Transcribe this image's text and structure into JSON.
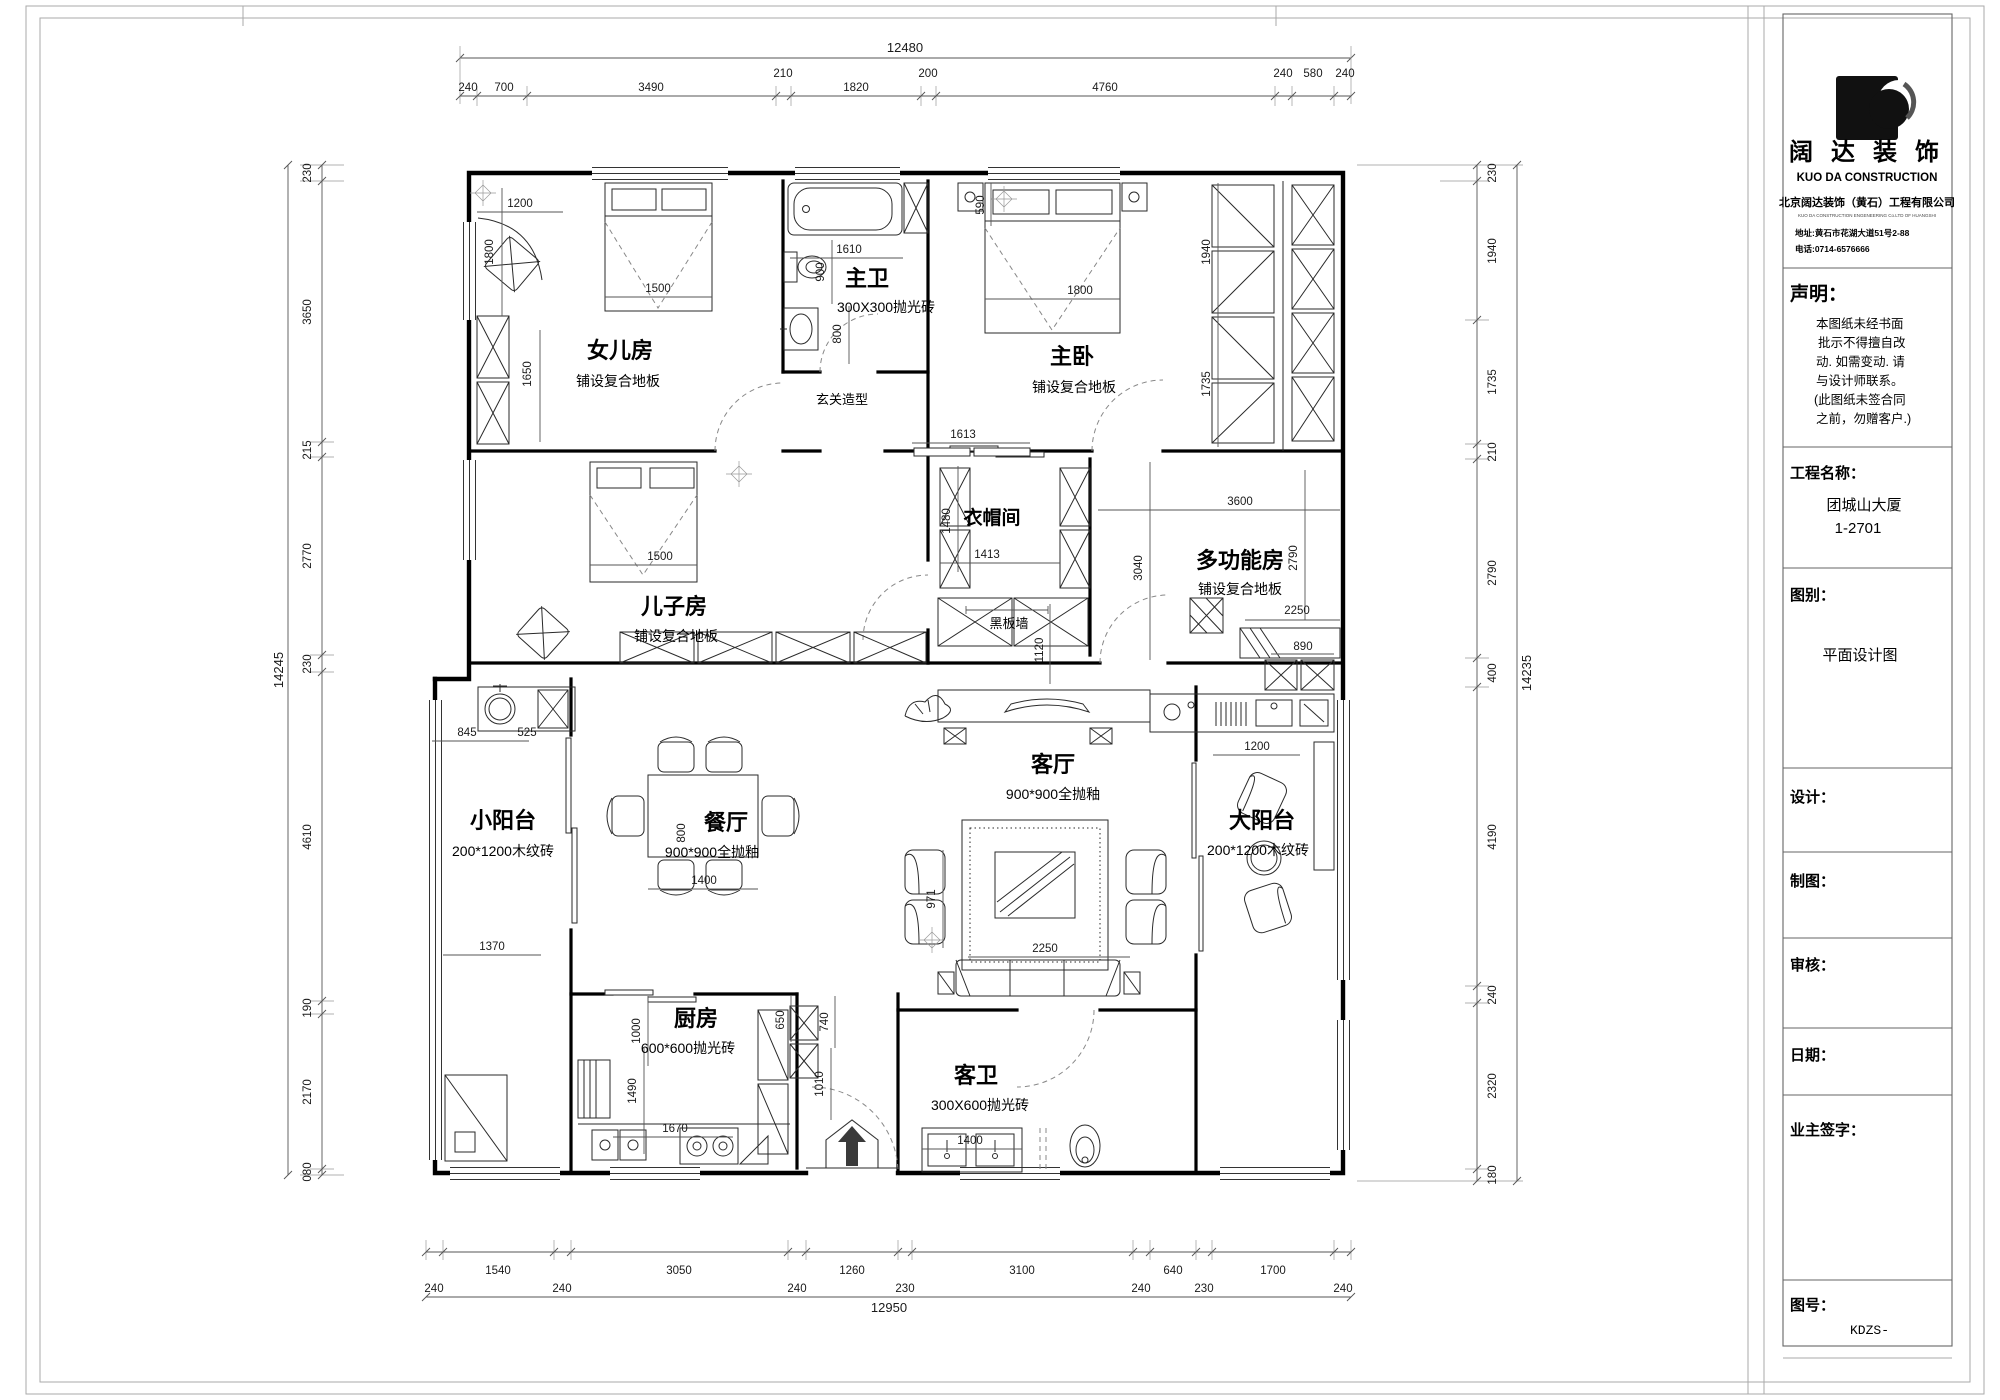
{
  "title_block": {
    "logo_title": "阔 达 装 饰",
    "logo_subtitle": "KUO DA CONSTRUCTION",
    "company_cn": "北京阔达装饰（黄石）工程有限公司",
    "company_en": "KUO DA CONSTRUCTION ENGENEERING Co.LTD OF HUANGSHI",
    "address": "地址:黄石市花湖大道51号2-88",
    "phone": "电话:0714-6576666",
    "statement_label": "声明：",
    "statement_lines": [
      "本图纸未经书面",
      "批示不得擅自改",
      "动. 如需变动. 请",
      "与设计师联系。",
      "(此图纸未签合同",
      "之前，勿赠客户.)"
    ],
    "project_label": "工程名称：",
    "project_name": "团城山大厦",
    "project_unit": "1-2701",
    "type_label": "图别：",
    "type_value": "平面设计图",
    "design_label": "设计：",
    "draft_label": "制图：",
    "check_label": "审核：",
    "date_label": "日期：",
    "owner_label": "业主签字：",
    "no_label": "图号：",
    "no_value": "KDZS-"
  },
  "plan": {
    "rooms": {
      "nver": {
        "name": "女儿房",
        "floor": "铺设复合地板"
      },
      "zhuwei": {
        "name": "主卫",
        "floor": "300X300抛光砖"
      },
      "zhuwo": {
        "name": "主卧",
        "floor": "铺设复合地板"
      },
      "erzi": {
        "name": "儿子房",
        "floor": "铺设复合地板"
      },
      "yimao": {
        "name": "衣帽间"
      },
      "duogong": {
        "name": "多功能房",
        "floor": "铺设复合地板"
      },
      "keting": {
        "name": "客厅",
        "floor": "900*900全抛釉"
      },
      "canting": {
        "name": "餐厅",
        "floor": "900*900全抛釉"
      },
      "xiaoyangtai": {
        "name": "小阳台",
        "floor": "200*1200木纹砖"
      },
      "dayangtai": {
        "name": "大阳台",
        "floor": "200*1200木纹砖"
      },
      "chufang": {
        "name": "厨房",
        "floor": "600*600抛光砖"
      },
      "kewei": {
        "name": "客卫",
        "floor": "300X600抛光砖"
      }
    },
    "annotations": {
      "xuanguan": "玄关造型",
      "heibanqiang": "黑板墙"
    },
    "dims": {
      "top": {
        "total": "12480",
        "segments": [
          "240",
          "700",
          "3490",
          "210",
          "1820",
          "200",
          "4760",
          "240",
          "580",
          "240"
        ]
      },
      "bottom": {
        "total": "12950",
        "segments": [
          "240",
          "1540",
          "240",
          "3050",
          "240",
          "1260",
          "230",
          "3100",
          "240",
          "640",
          "230",
          "1700",
          "240"
        ]
      },
      "left": {
        "total": "14245",
        "segments": [
          "230",
          "3650",
          "215",
          "2770",
          "230",
          "4610",
          "190",
          "2170",
          "080"
        ]
      },
      "right": {
        "total": "14235",
        "segments": [
          "230",
          "1940",
          "1735",
          "210",
          "2790",
          "400",
          "4190",
          "240",
          "2320",
          "180"
        ]
      },
      "interior": {
        "nver_top": "1200",
        "nver_left": "1800",
        "nver_bed": "1500",
        "nver_low": "1650",
        "zw_w1": "1610",
        "zw_v1": "900",
        "zw_v2": "800",
        "shaft": "590",
        "zwo_bed": "1800",
        "cl_a": "1940",
        "cl_b": "1735",
        "hall": "1613",
        "ym_v": "1480",
        "ym_w": "1413",
        "hb_v": "1120",
        "dg_w": "3600",
        "dg_v1": "3040",
        "dg_v2": "2790",
        "dg_bed": "2250",
        "counter_w": "890",
        "ez_bed": "1500",
        "xyt_a": "845",
        "xyt_b": "525",
        "xyt_w": "1370",
        "ct_v": "800",
        "ct_w": "1400",
        "kt_v": "971",
        "sofa": "2250",
        "dyt_w": "1200",
        "kit_v1": "1000",
        "kit_v2": "1490",
        "kit_w": "1670",
        "kit_v3": "650",
        "kit_v4": "740",
        "kit_v5": "1010",
        "kw_w": "1400"
      }
    }
  }
}
